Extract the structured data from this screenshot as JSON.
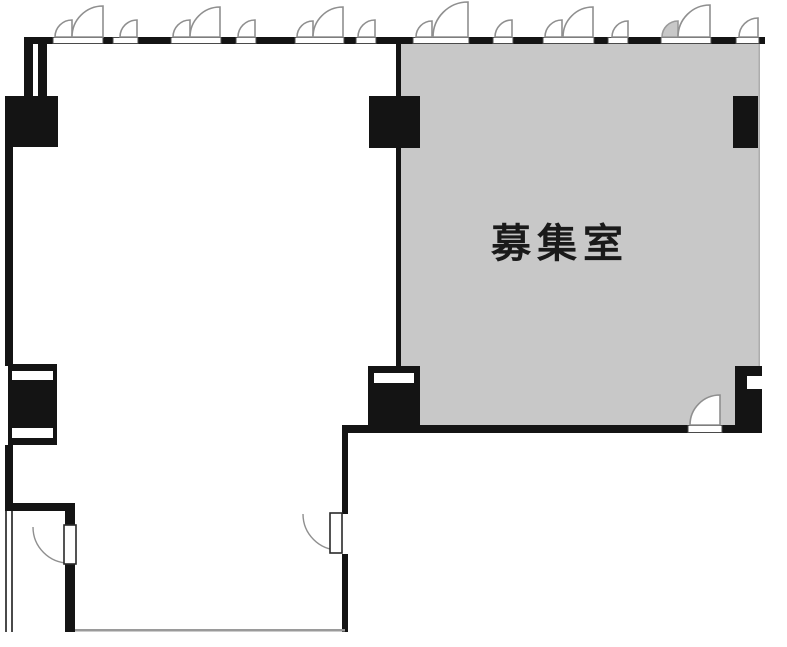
{
  "floorplan": {
    "room_label": "募集室",
    "colors": {
      "vacant_room_fill": "#c8c8c8",
      "wall": "#141414",
      "background": "#ffffff",
      "swing_arc": "#8f8f8f"
    }
  }
}
